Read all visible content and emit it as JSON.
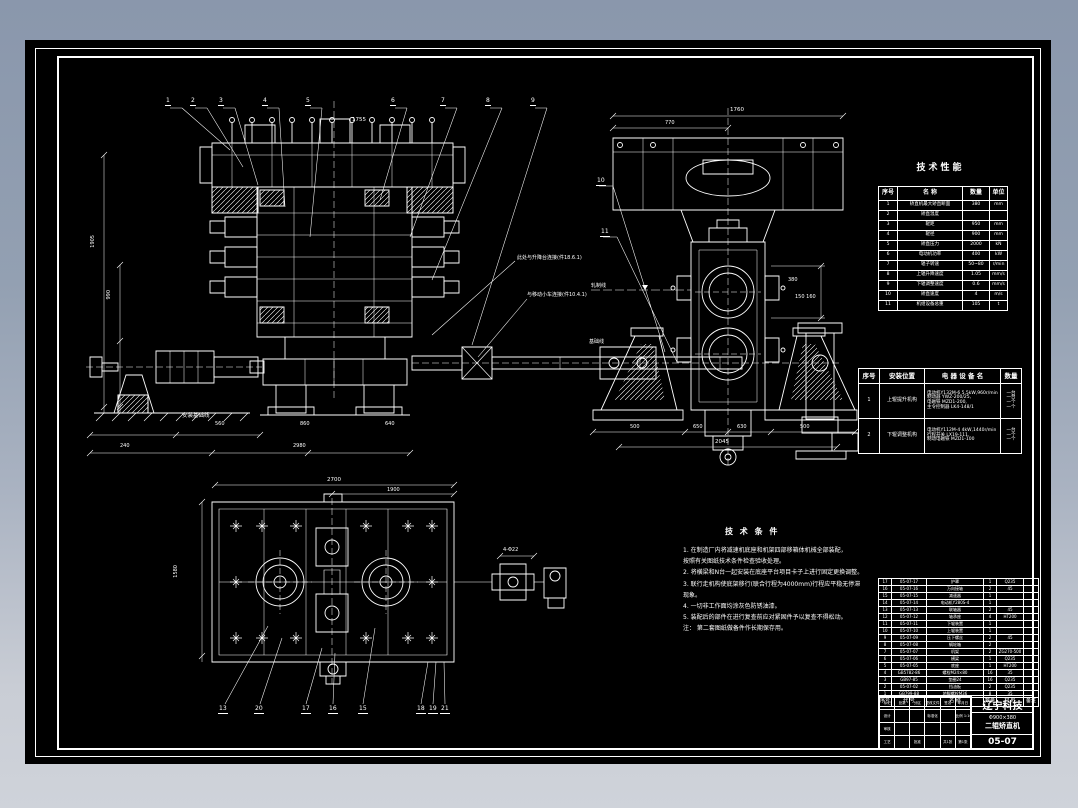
{
  "app": {
    "bg_top": "#8a97ac",
    "bg_bottom": "#cfd3da",
    "paper": "#000000",
    "ink": "#ffffff"
  },
  "drawing": {
    "callouts": {
      "front": [
        "1",
        "2",
        "3",
        "4",
        "5",
        "6",
        "7",
        "8",
        "9"
      ],
      "side": [
        "10",
        "11"
      ],
      "plan": [
        "13",
        "20",
        "17",
        "16",
        "15",
        "18",
        "19",
        "21"
      ]
    },
    "dims": {
      "front_top": "1755",
      "front_b1a": "560",
      "front_b1b": "860",
      "front_b1c": "640",
      "front_b2a": "240",
      "front_b2b": "2980",
      "front_v1": "1905",
      "front_v2": "990",
      "side_top": "1760",
      "side_top2": "770",
      "side_b1": "500",
      "side_b2": "650",
      "side_b3": "630",
      "side_b4": "500",
      "side_total": "2045",
      "side_r": "380",
      "shaft_dims": "150  160",
      "plan_top": "2700",
      "plan_top2": "1900",
      "plan_v": "1580",
      "plan_hole": "4-Φ22"
    },
    "labels": {
      "connect1": "此处与升降台连接(件18.6.1)",
      "connect2": "与移动小车连接(件10.4.1)",
      "ground": "安装基础线",
      "rail_line": "轧制线",
      "base_line": "基础线"
    }
  },
  "tech_table": {
    "title": "技术性能",
    "headers": [
      "序号",
      "名      称",
      "数量",
      "单位"
    ],
    "rows": [
      [
        "1",
        "矫直机最大矫直断面",
        "380",
        "mm"
      ],
      [
        "2",
        "矫直温度",
        "",
        ""
      ],
      [
        "3",
        "辊距",
        "950",
        "mm"
      ],
      [
        "4",
        "辊径",
        "900",
        "mm"
      ],
      [
        "5",
        "矫直压力",
        "2000",
        "kN"
      ],
      [
        "6",
        "电动机功率",
        "400",
        "kW"
      ],
      [
        "7",
        "辊子转速",
        "50~80",
        "r/min"
      ],
      [
        "8",
        "上辊升降速度",
        "1.05",
        "mm/s"
      ],
      [
        "9",
        "下辊调整速度",
        "0.6",
        "mm/s"
      ],
      [
        "10",
        "矫直速度",
        "4",
        "m/s"
      ],
      [
        "11",
        "机组设备总重",
        "105",
        "t"
      ]
    ]
  },
  "electric_table": {
    "headers": [
      "序号",
      "安装位置",
      "电  器  设  备  名",
      "数量"
    ],
    "rows": [
      {
        "seq": "1",
        "location": "上辊提升机构",
        "equipment": [
          "电动机Y132M-6 5.5kW,960r/min",
          "制动器 YWZ-200/25,",
          "电磁铁 MZD1-200,",
          "主令控制器 LK4-148/1"
        ],
        "qty": [
          "一台",
          "一台",
          "一个",
          "一个"
        ]
      },
      {
        "seq": "2",
        "location": "下辊调整机构",
        "equipment": [
          "电动机Y112M-4 4kW,1440r/min",
          "行程开关 LX19-111,",
          "制动电磁铁 MZD1-100"
        ],
        "qty": [
          "一台",
          "一个",
          "一个"
        ]
      }
    ]
  },
  "tech_notes": {
    "title": "技 术 条 件",
    "lines": [
      "1. 在制造厂内将减速机底座和机架四部移箱体机械全部装配，",
      "    按照有关图纸技术条件检查验收处理。",
      "2. 将横梁和N台一起安装在底座平台项目卡子上进行固定更换调整。",
      "3. 联行走机构使底架移行(联合行程为4000mm)行程应平稳无停滞",
      "    现象。",
      "4. 一切非工作面均涂灰色防锈油漆。",
      "5. 装配后的部件在进行复查前应对紧固件予以复查不得松动。",
      "注：  第二套图纸做备件作长期保存用。"
    ]
  },
  "parts_list": {
    "headers": [
      "序号",
      "代  号",
      "名    称",
      "数量",
      "材 料",
      "备注"
    ],
    "rows": [
      [
        "17",
        "05-07-17",
        "护罩",
        "1",
        "Q235",
        ""
      ],
      [
        "16",
        "05-07-16",
        "万向接轴",
        "2",
        "45",
        ""
      ],
      [
        "15",
        "05-07-15",
        "减速器",
        "1",
        "",
        ""
      ],
      [
        "14",
        "05-07-14",
        "电动机Y280S-4",
        "1",
        "",
        ""
      ],
      [
        "13",
        "05-07-13",
        "联轴器",
        "2",
        "45",
        ""
      ],
      [
        "12",
        "05-07-12",
        "轴承座",
        "4",
        "HT200",
        ""
      ],
      [
        "11",
        "05-07-11",
        "下辊装置",
        "1",
        "",
        ""
      ],
      [
        "10",
        "05-07-10",
        "上辊装置",
        "1",
        "",
        ""
      ],
      [
        "9",
        "05-07-09",
        "压下螺丝",
        "2",
        "45",
        ""
      ],
      [
        "8",
        "05-07-08",
        "蜗轮箱",
        "2",
        "",
        ""
      ],
      [
        "7",
        "05-07-07",
        "机架",
        "2",
        "ZG270-500",
        ""
      ],
      [
        "6",
        "05-07-06",
        "横梁",
        "1",
        "Q235",
        ""
      ],
      [
        "5",
        "05-07-05",
        "底座",
        "1",
        "HT200",
        ""
      ],
      [
        "4",
        "GB5782-86",
        "螺栓M24×80",
        "16",
        "35",
        ""
      ],
      [
        "3",
        "GB97-85",
        "垫圈24",
        "16",
        "Q235",
        ""
      ],
      [
        "2",
        "05-07-02",
        "挡油板",
        "2",
        "Q235",
        ""
      ],
      [
        "1",
        "GB799-88",
        "地脚螺栓M36",
        "8",
        "35",
        ""
      ]
    ]
  },
  "title_block": {
    "company": "辽宁科技",
    "product_line1": "Φ900×380",
    "product_line2": "二辊矫直机",
    "drawing_no": "05-07",
    "left_rows": [
      [
        "标记",
        "处数",
        "分区",
        "更改文件号",
        "签名",
        "年月日"
      ],
      [
        "设计",
        "",
        "",
        "标准化",
        "",
        "比例 1:10"
      ],
      [
        "审核",
        "",
        "",
        "",
        "",
        ""
      ],
      [
        "工艺",
        "",
        "批准",
        "",
        "共1张",
        "第1张"
      ]
    ]
  }
}
